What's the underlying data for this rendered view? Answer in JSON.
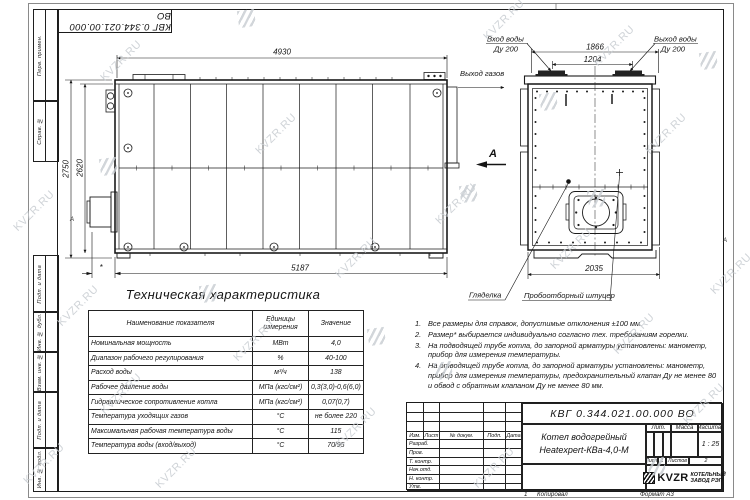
{
  "watermark": {
    "text": "KVZR.RU"
  },
  "frame": {
    "top_designation": "КВГ 0.344.021.00.000 ВО",
    "left_labels": [
      "Перв. примен.",
      "Справ. №",
      "Подп. и дата",
      "Инв. № дубл.",
      "Взам. инв. №",
      "Подп. и дата",
      "Инв. № подл."
    ],
    "zone_left": "А",
    "zone_right": "А"
  },
  "side_view": {
    "dim_top": "4930",
    "dim_height_outer": "2750",
    "dim_height_inner": "2620",
    "dim_bottom": "5187",
    "dim_burner": "*"
  },
  "end_view": {
    "label_water_in": "Вход воды",
    "label_water_in_dn": "Ду 200",
    "label_water_out": "Выход воды",
    "label_water_out_dn": "Ду 200",
    "label_gas_out": "Выход газов",
    "view_arrow": "А",
    "dim_w1": "1866",
    "dim_w2": "1204",
    "dim_bottom": "2035",
    "label_peephole": "Гляделка",
    "label_sampler": "Пробоотборный штуцер"
  },
  "spec_table": {
    "title": "Техническая характеристика",
    "headers": [
      "Наименование показателя",
      "Единицы измерения",
      "Значение"
    ],
    "rows": [
      [
        "Номинальная мощность",
        "МВт",
        "4,0"
      ],
      [
        "Диапазон рабочего регулирования",
        "%",
        "40-100"
      ],
      [
        "Расход воды",
        "м³/ч",
        "138"
      ],
      [
        "Рабочее давление воды",
        "МПа (кгс/см²)",
        "0,3(3,0)-0,6(6,0)"
      ],
      [
        "Гидравлическое сопротивление котла",
        "МПа (кгс/см²)",
        "0,07(0,7)"
      ],
      [
        "Температура уходящих газов",
        "°С",
        "не более 220"
      ],
      [
        "Максимальная рабочая температура воды",
        "°С",
        "115"
      ],
      [
        "Температура воды (вход/выход)",
        "°С",
        "70/95"
      ]
    ]
  },
  "notes": {
    "items": [
      {
        "num": "1.",
        "text": "Все размеры для справок, допустимые отклонения ±100 мм."
      },
      {
        "num": "2.",
        "text": "Размер* выбирается индивидуально согласно тех. требованиям горелки."
      },
      {
        "num": "3.",
        "text": "На подводящей трубе котла, до запорной арматуры установлены: манометр, прибор для измерения температуры."
      },
      {
        "num": "4.",
        "text": "На отводящей трубе котла, до запорной арматуры установлены: манометр, прибор для измерения температуры, предохранительный клапан Ду не менее 80 и обвод с обратным клапаном Ду не менее 80 мм."
      }
    ]
  },
  "title_block": {
    "designation": "КВГ 0.344.021.00.000 ВО",
    "name_line1": "Котел водогрейный",
    "name_line2": "Heatexpert-КВа-4,0-М",
    "header_cols": [
      "Изм.",
      "Лист",
      "№ докум.",
      "Подп.",
      "Дата"
    ],
    "row_labels": [
      "Разраб.",
      "Пров.",
      "Т. контр.",
      "Нач.отд.",
      "Н. контр.",
      "Утв."
    ],
    "lit_label": "Лит.",
    "mass_label": "Масса",
    "scale_label": "Масштаб",
    "scale_value": "1 : 25",
    "sheet_label": "Лист",
    "sheet_value": "1",
    "sheets_label": "Листов",
    "sheets_value": "2",
    "company_logo": "KVZR",
    "company_line1": "КОТЕЛЬНЫЙ",
    "company_line2": "ЗАВОД РЭП"
  },
  "footer": {
    "copy_num": "1",
    "copied": "Копировал",
    "format": "Формат А3"
  }
}
